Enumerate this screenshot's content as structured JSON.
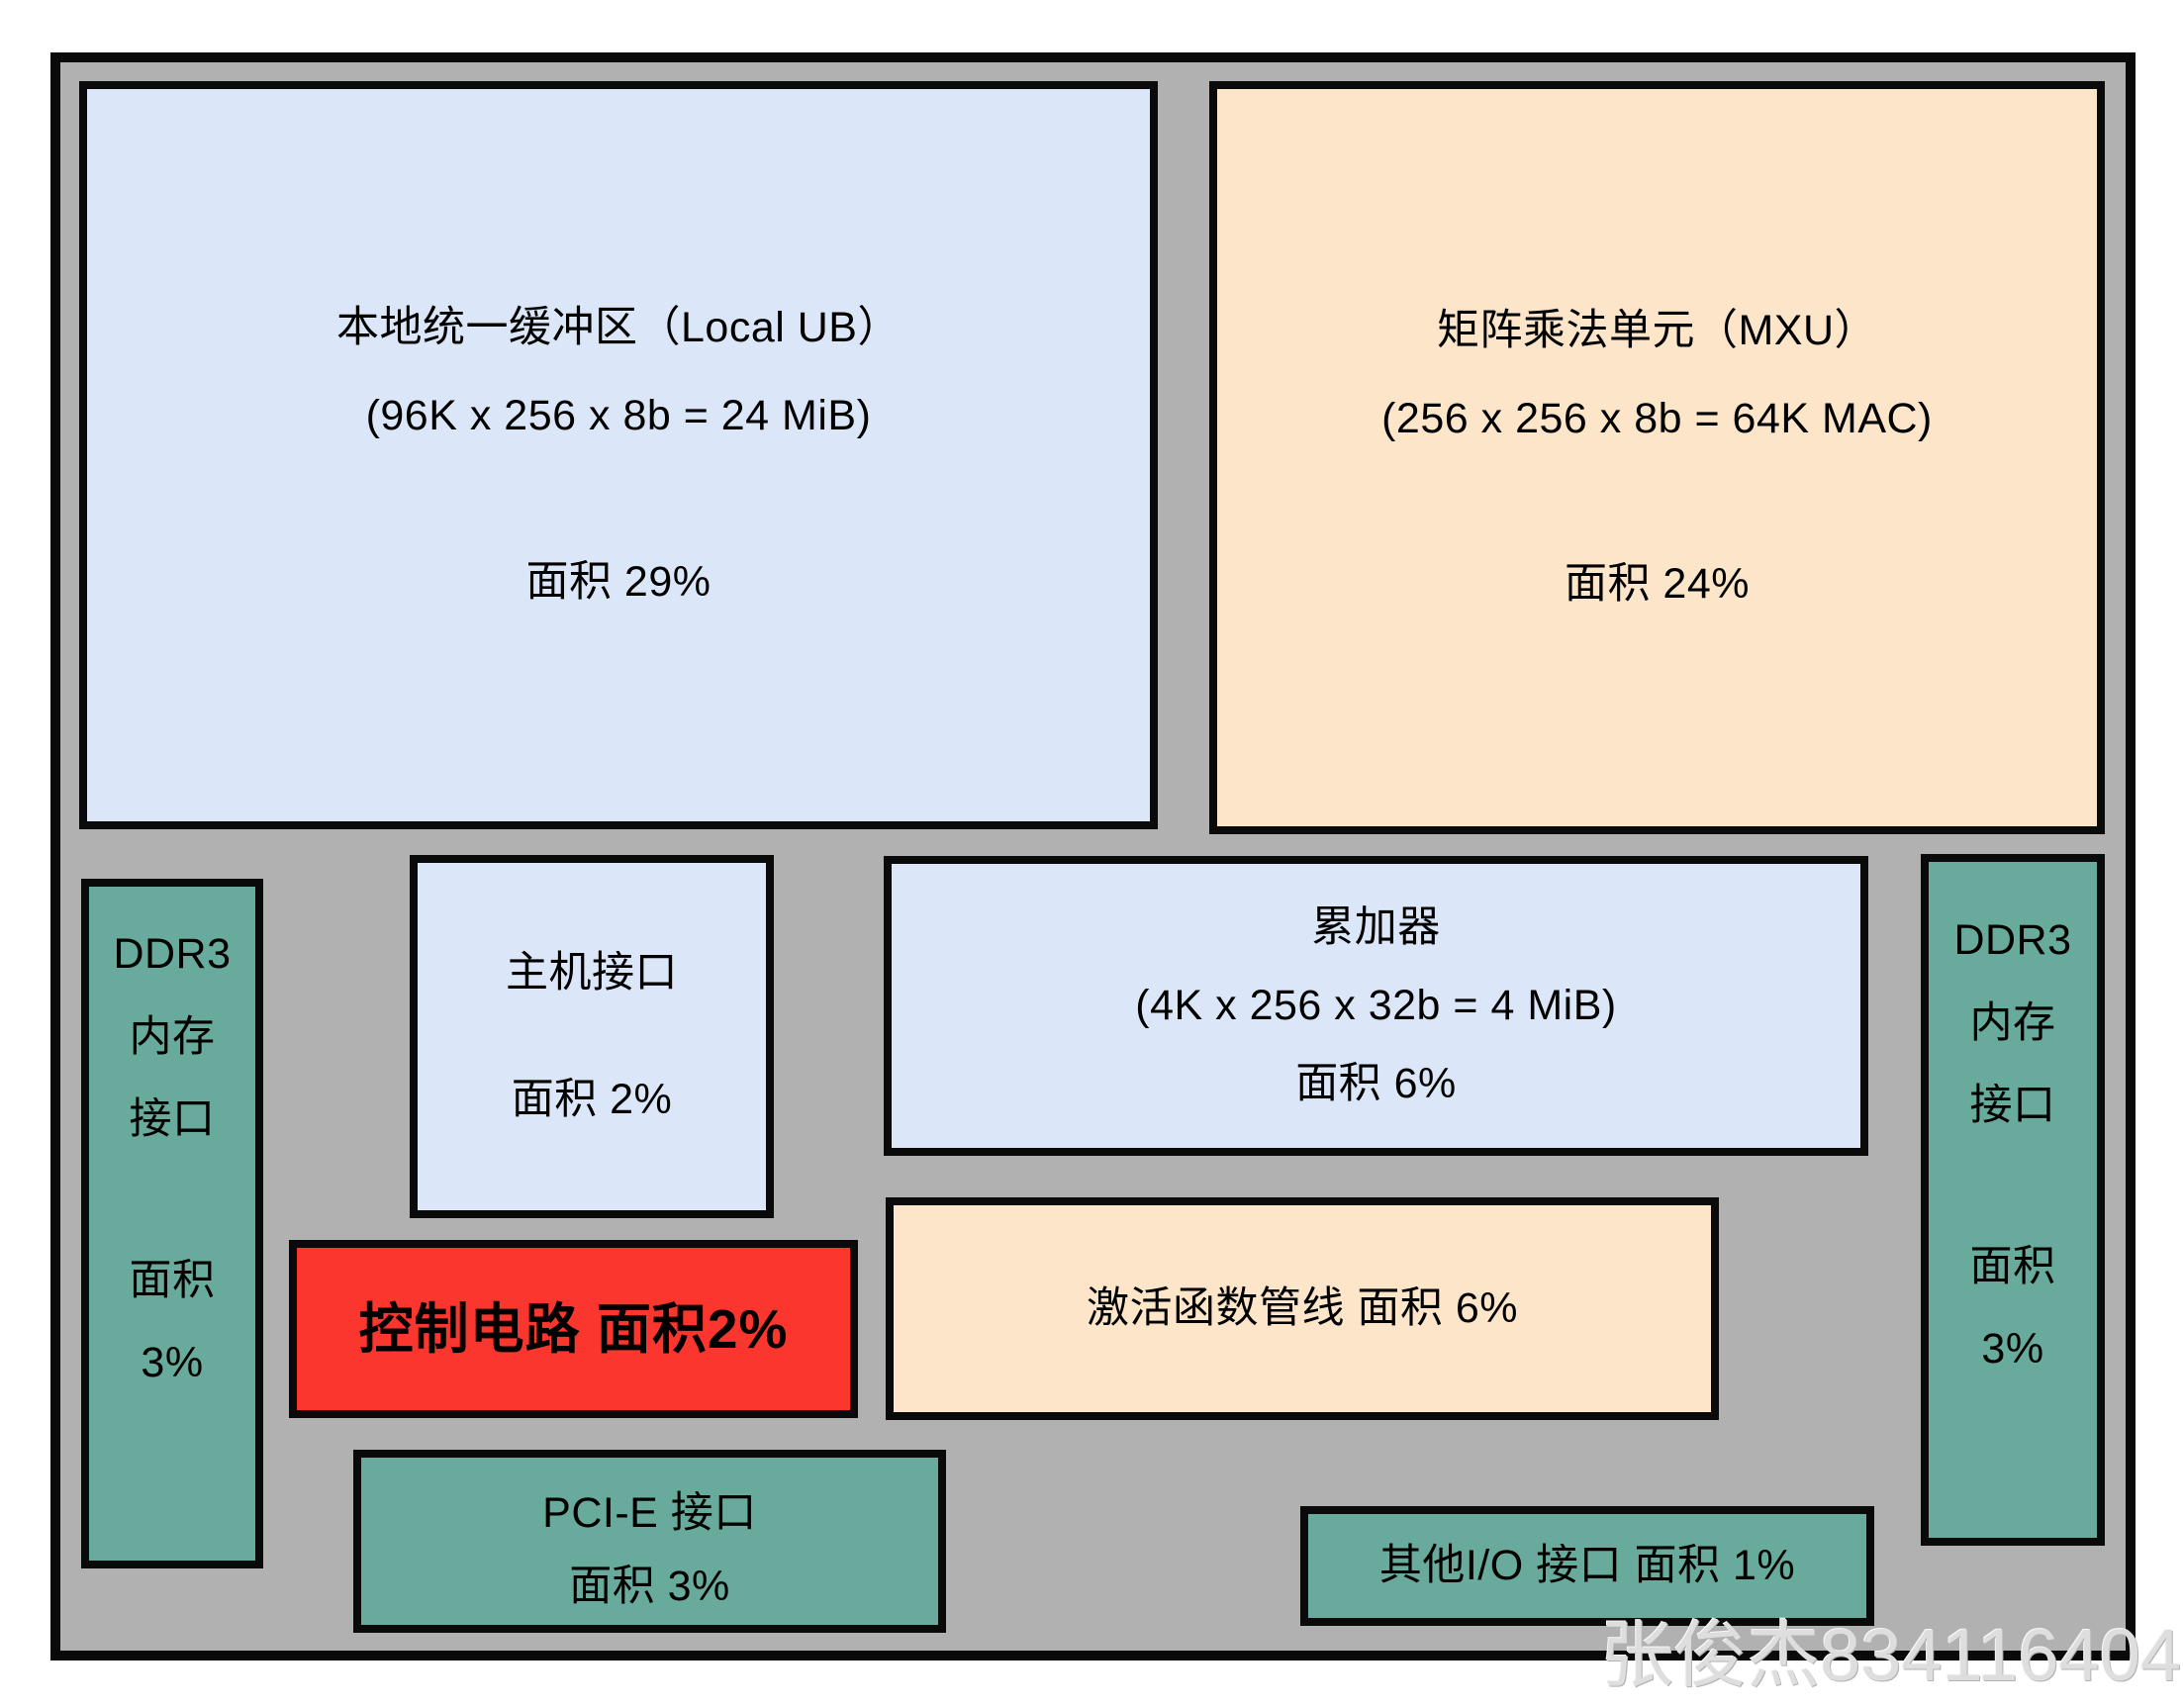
{
  "colors": {
    "die_background": "#b1b1b1",
    "buffer_blue": "#dbe7f8",
    "compute_peach": "#fce5c8",
    "io_teal": "#68aa9b",
    "control_red": "#fa362e",
    "border_black": "#0a0a0a",
    "watermark_gray": "#dedede"
  },
  "blocks": {
    "local_ub": {
      "title": "本地统一缓冲区（Local UB）",
      "spec": "(96K x 256 x 8b = 24 MiB)",
      "area": "面积 29%"
    },
    "mxu": {
      "title": "矩阵乘法单元（MXU）",
      "spec": "(256 x 256 x 8b = 64K MAC)",
      "area": "面积 24%"
    },
    "host_interface": {
      "title": "主机接口",
      "area": "面积 2%"
    },
    "accumulators": {
      "title": "累加器",
      "spec": "(4K x 256 x 32b = 4 MiB)",
      "area": "面积 6%"
    },
    "ddr3_left": {
      "name": "DDR3",
      "line2": "内存",
      "line3": "接口",
      "area_label": "面积",
      "area_value": "3%"
    },
    "ddr3_right": {
      "name": "DDR3",
      "line2": "内存",
      "line3": "接口",
      "area_label": "面积",
      "area_value": "3%"
    },
    "control_logic": {
      "label": "控制电路 面积2%"
    },
    "activation_pipeline": {
      "label": "激活函数管线 面积 6%"
    },
    "pcie_interface": {
      "title": "PCI-E 接口",
      "area": "面积 3%"
    },
    "other_io": {
      "label": "其他I/O 接口 面积 1%"
    }
  },
  "watermark": "张俊杰834116404"
}
